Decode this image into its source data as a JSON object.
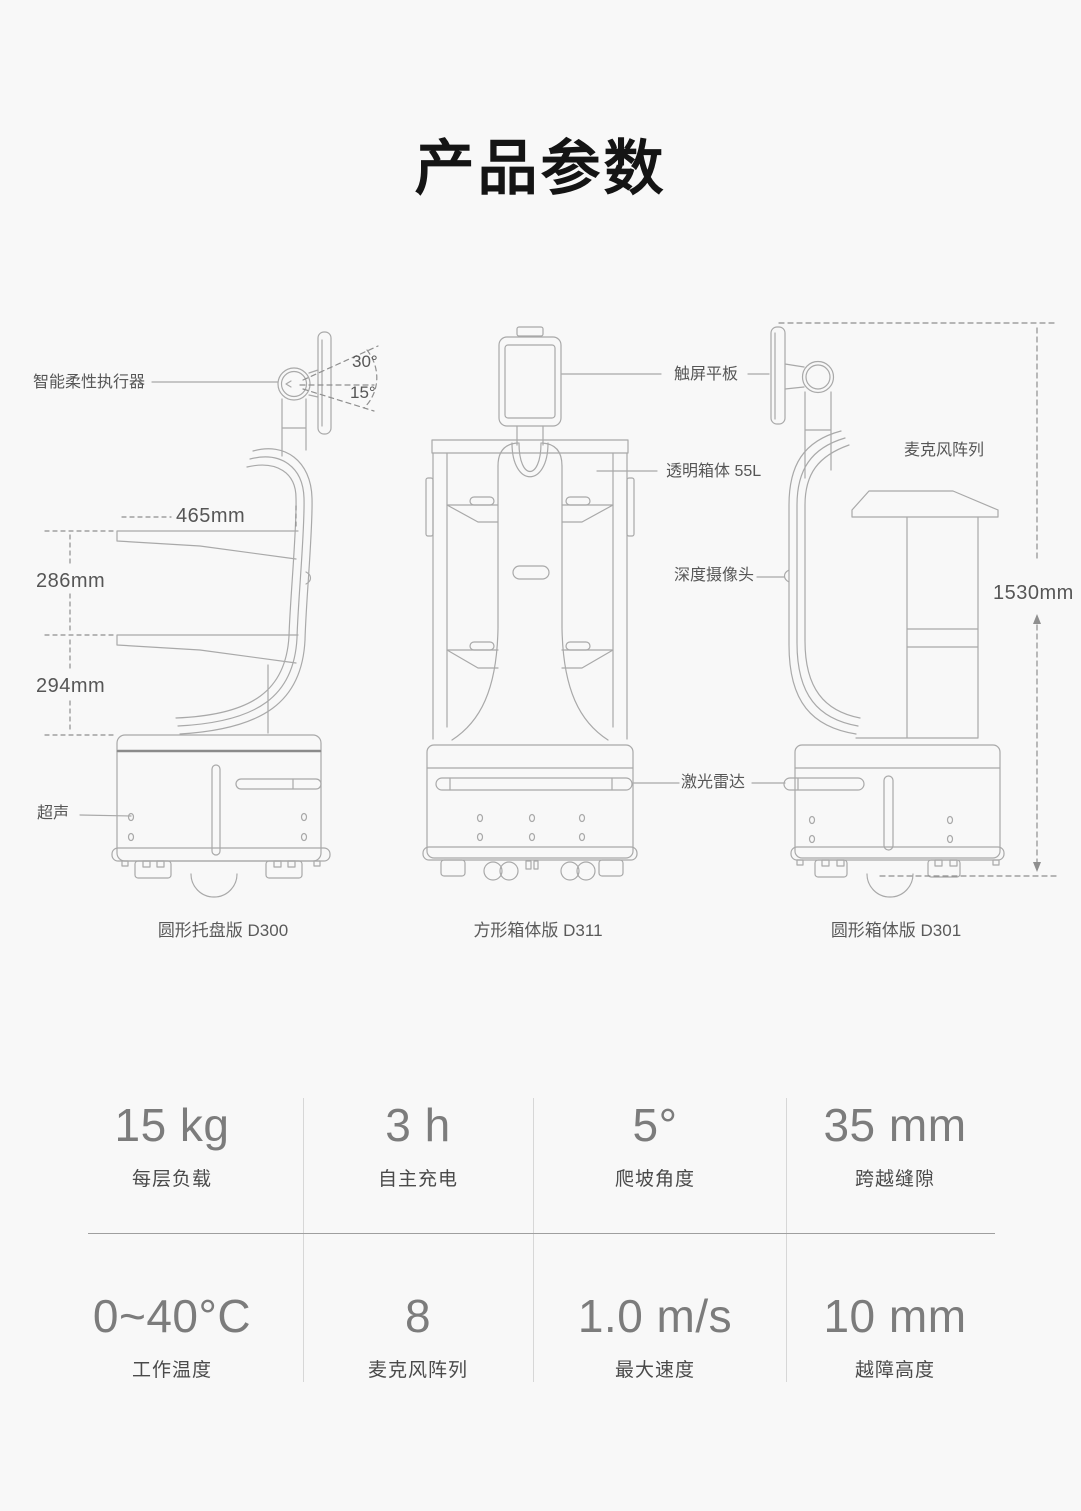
{
  "page": {
    "title": "产品参数"
  },
  "diagram": {
    "annotations": {
      "actuator": "智能柔性执行器",
      "tilt_up": "30°",
      "tilt_down": "15°",
      "tray_width": "465mm",
      "shelf_gap_upper": "286mm",
      "shelf_gap_lower": "294mm",
      "ultrasonic": "超声",
      "touch_tablet": "触屏平板",
      "transparent_box": "透明箱体 55L",
      "depth_camera": "深度摄像头",
      "lidar": "激光雷达",
      "mic_array": "麦克风阵列",
      "total_height": "1530mm"
    },
    "captions": {
      "d300": "圆形托盘版 D300",
      "d311": "方形箱体版 D311",
      "d301": "圆形箱体版 D301"
    }
  },
  "specs": {
    "cells": [
      {
        "value": "15 kg",
        "label": "每层负载"
      },
      {
        "value": "3 h",
        "label": "自主充电"
      },
      {
        "value": "5°",
        "label": "爬坡角度"
      },
      {
        "value": "35 mm",
        "label": "跨越缝隙"
      },
      {
        "value": "0~40°C",
        "label": "工作温度"
      },
      {
        "value": "8",
        "label": "麦克风阵列"
      },
      {
        "value": "1.0 m/s",
        "label": "最大速度"
      },
      {
        "value": "10 mm",
        "label": "越障高度"
      }
    ]
  }
}
